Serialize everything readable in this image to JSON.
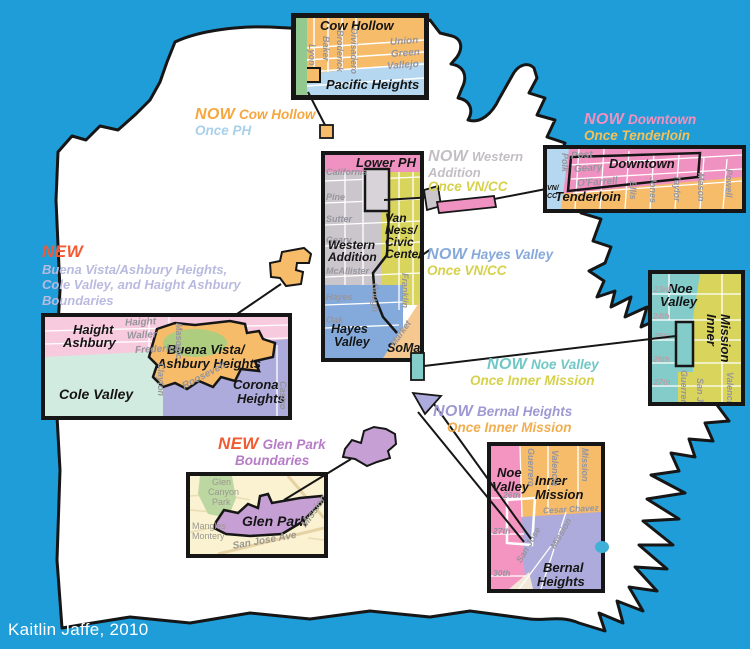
{
  "credit": "Kaitlin Jaffe, 2010",
  "colors": {
    "background": "#1F9DD8",
    "land": "#FFFFFF",
    "outline": "#161616",
    "orange": "#F6BC6A",
    "light_blue": "#B5D7EF",
    "pink_strong": "#F092C1",
    "pink_light": "#F8CADE",
    "gray_area": "#CBC6CC",
    "yellow_green": "#D9D45C",
    "hayes_blue": "#84AADB",
    "soma_tan": "#F5C88F",
    "noe_teal": "#83CCCA",
    "lavender": "#ACABDB",
    "mint": "#D2EBE0",
    "glen_purple": "#C6A0D4",
    "cream": "#FAF2D0",
    "park_green": "#AFCD7E",
    "presidio_green": "#92C98F",
    "new_red": "#F15A33",
    "periwinkle_text": "#B9BADF"
  },
  "callouts": {
    "cow_hollow": {
      "now_word": "NOW",
      "now_name": "Cow Hollow",
      "once_line": "Once PH"
    },
    "western_addition": {
      "now_word": "NOW",
      "now_name": "Western",
      "now_name2": "Addition",
      "once_line": "Once VN/CC"
    },
    "downtown": {
      "now_word": "NOW",
      "now_name": "Downtown",
      "once_line": "Once Tenderloin"
    },
    "hayes_valley": {
      "now_word": "NOW",
      "now_name": "Hayes Valley",
      "once_line": "Once VN/CC"
    },
    "noe_valley": {
      "now_word": "NOW",
      "now_name": "Noe Valley",
      "once_line": "Once Inner Mission"
    },
    "bernal": {
      "now_word": "NOW",
      "now_name": "Bernal Heights",
      "once_line": "Once Inner Mission"
    },
    "buena_vista": {
      "new_word": "NEW",
      "line1": "Buena Vista/Ashbury Heights,",
      "line2": "Cole Valley, and Haight Ashbury",
      "line3": "Boundaries"
    },
    "glen_park": {
      "new_word": "NEW",
      "name": "Glen Park",
      "line2": "Boundaries"
    }
  },
  "boxes": {
    "cow_hollow": {
      "title": "Cow Hollow",
      "secondary": "Pacific Heights",
      "v_streets": [
        "Lyon",
        "Baker",
        "Broderick",
        "Divisadero"
      ],
      "h_streets": [
        "Union",
        "Green",
        "Vallejo"
      ]
    },
    "lower_ph": {
      "header": "Lower PH",
      "h_streets": [
        "California",
        "Pine",
        "Sutter",
        "Geary",
        "McAllister",
        "Hayes",
        "Oak"
      ],
      "v_streets": [
        "Gough",
        "Franklin"
      ],
      "diag_street": "Market",
      "area_wa1": "Western",
      "area_wa2": "Addition",
      "area_vn1": "Van",
      "area_vn2": "Ness/",
      "area_vn3": "Civic",
      "area_vn4": "Center",
      "area_hv1": "Hayes",
      "area_hv2": "Valley",
      "area_soma": "SoMa"
    },
    "downtown": {
      "area_downtown": "Downtown",
      "area_tenderloin": "Tenderloin",
      "vncc1": "VN/",
      "vncc2": "CC",
      "h_streets": [
        "Post",
        "Geary",
        "O'Farrell"
      ],
      "v_streets": [
        "Polk",
        "Ellis",
        "Jones",
        "Taylor",
        "Mason",
        "Powell"
      ]
    },
    "noe_mission": {
      "area_noe1": "Noe",
      "area_noe2": "Valley",
      "area_inner1": "Inner",
      "area_inner2": "Mission",
      "h_streets": [
        "23rd",
        "24th",
        "25th",
        "26th",
        "27th"
      ],
      "v_streets": [
        "Guerrero",
        "San Jose",
        "Valencia"
      ]
    },
    "haight": {
      "area_ha1": "Haight",
      "area_ha2": "Ashbury",
      "area_cole": "Cole Valley",
      "area_bv1": "Buena Vista/",
      "area_bv2": "Ashbury Heights",
      "area_corona1": "Corona",
      "area_corona2": "Heights",
      "h_streets": [
        "Haight",
        "Waller",
        "Frederick"
      ],
      "v_streets": [
        "Masonic",
        "Clayton",
        "Castro"
      ],
      "diag_street": "Roosevelt"
    },
    "glen_park": {
      "park1": "Glen",
      "park2": "Canyon",
      "park3": "Park",
      "area": "Glen Park",
      "streets": [
        "Mangles",
        "Montery"
      ],
      "diag1": "San Jose Ave",
      "diag2": "Mission"
    },
    "bernal": {
      "area_noe1": "Noe",
      "area_noe2": "Valley",
      "area_inner1": "Inner",
      "area_inner2": "Mission",
      "area_bernal1": "Bernal",
      "area_bernal2": "Heights",
      "h_streets": [
        "26th",
        "Cesar Chavez",
        "27th",
        "30th"
      ],
      "v_streets": [
        "Guerrero",
        "Valencia",
        "Mission"
      ],
      "diag_streets": [
        "San Jose",
        "Mission"
      ]
    }
  }
}
